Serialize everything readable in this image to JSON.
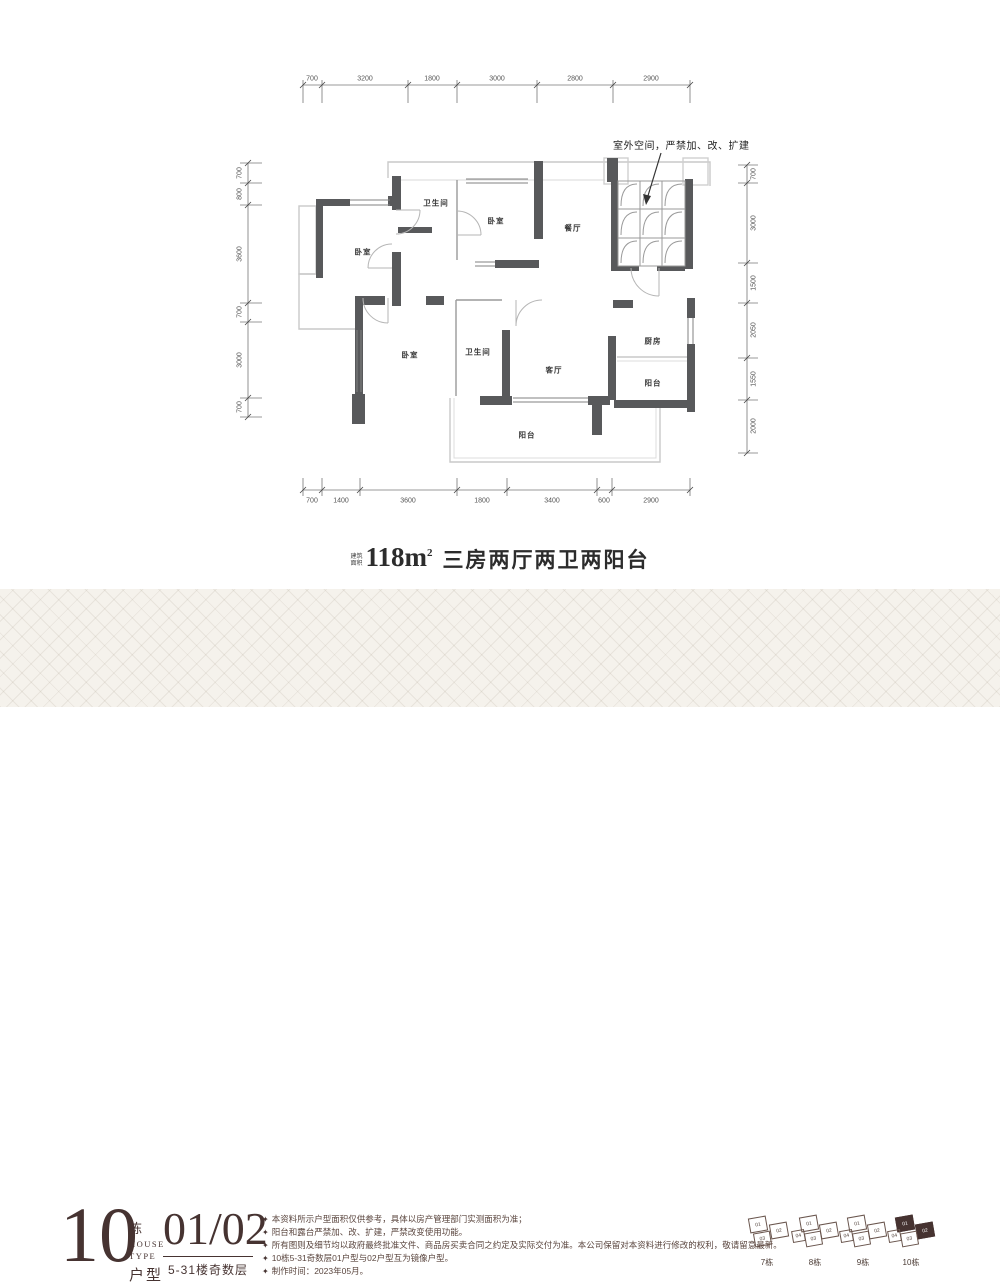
{
  "plan": {
    "annotation": "室外空间，严禁加、改、扩建",
    "rooms": {
      "bath_top": "卫生间",
      "bedroom_tm": "卧室",
      "dining": "餐厅",
      "bedroom_tl": "卧室",
      "bedroom_ll": "卧室",
      "bath_low": "卫生间",
      "living": "客厅",
      "kitchen": "厨房",
      "balcony_right": "阳台",
      "balcony_bottom": "阳台"
    },
    "dims": {
      "top": [
        "700",
        "3200",
        "1800",
        "3000",
        "2800",
        "2900"
      ],
      "bottom": [
        "700",
        "1400",
        "3600",
        "1800",
        "3400",
        "600",
        "2900"
      ],
      "left": [
        "700",
        "800",
        "3600",
        "700",
        "3000",
        "700"
      ],
      "right": [
        "700",
        "3000",
        "1500",
        "2050",
        "1550",
        "2000"
      ]
    },
    "wall_color": "#58595b"
  },
  "caption": {
    "area_prefix_1": "建筑",
    "area_prefix_2": "面积",
    "area_value": "118m",
    "area_sup": "2",
    "desc": "三房两厅两卫两阳台"
  },
  "footer": {
    "accent_color": "#463331",
    "block_number": "10",
    "dong": "栋",
    "house": "HOUSE",
    "type": "TYPE",
    "huxing": "户型",
    "unit_numbers": "01/02",
    "floors": "5-31楼奇数层",
    "bullet": "✦",
    "notes": [
      "本资料所示户型面积仅供参考，具体以房产管理部门实测面积为准；",
      "阳台和露台严禁加、改、扩建，严禁改变使用功能。",
      "所有图则及细节均以政府最终批准文件、商品房买卖合同之约定及实际交付为准。本公司保留对本资料进行修改的权利，敬请留意最新。",
      "10栋5-31奇数层01户型与02户型互为镜像户型。",
      "制作时间：2023年05月。"
    ],
    "buildings": [
      {
        "label": "7栋",
        "units": [
          "01",
          "02",
          "03"
        ]
      },
      {
        "label": "8栋",
        "units": [
          "01",
          "02",
          "04",
          "03"
        ]
      },
      {
        "label": "9栋",
        "units": [
          "01",
          "02",
          "04",
          "03"
        ]
      },
      {
        "label": "10栋",
        "units": [
          "01",
          "02",
          "04",
          "03"
        ]
      }
    ]
  }
}
